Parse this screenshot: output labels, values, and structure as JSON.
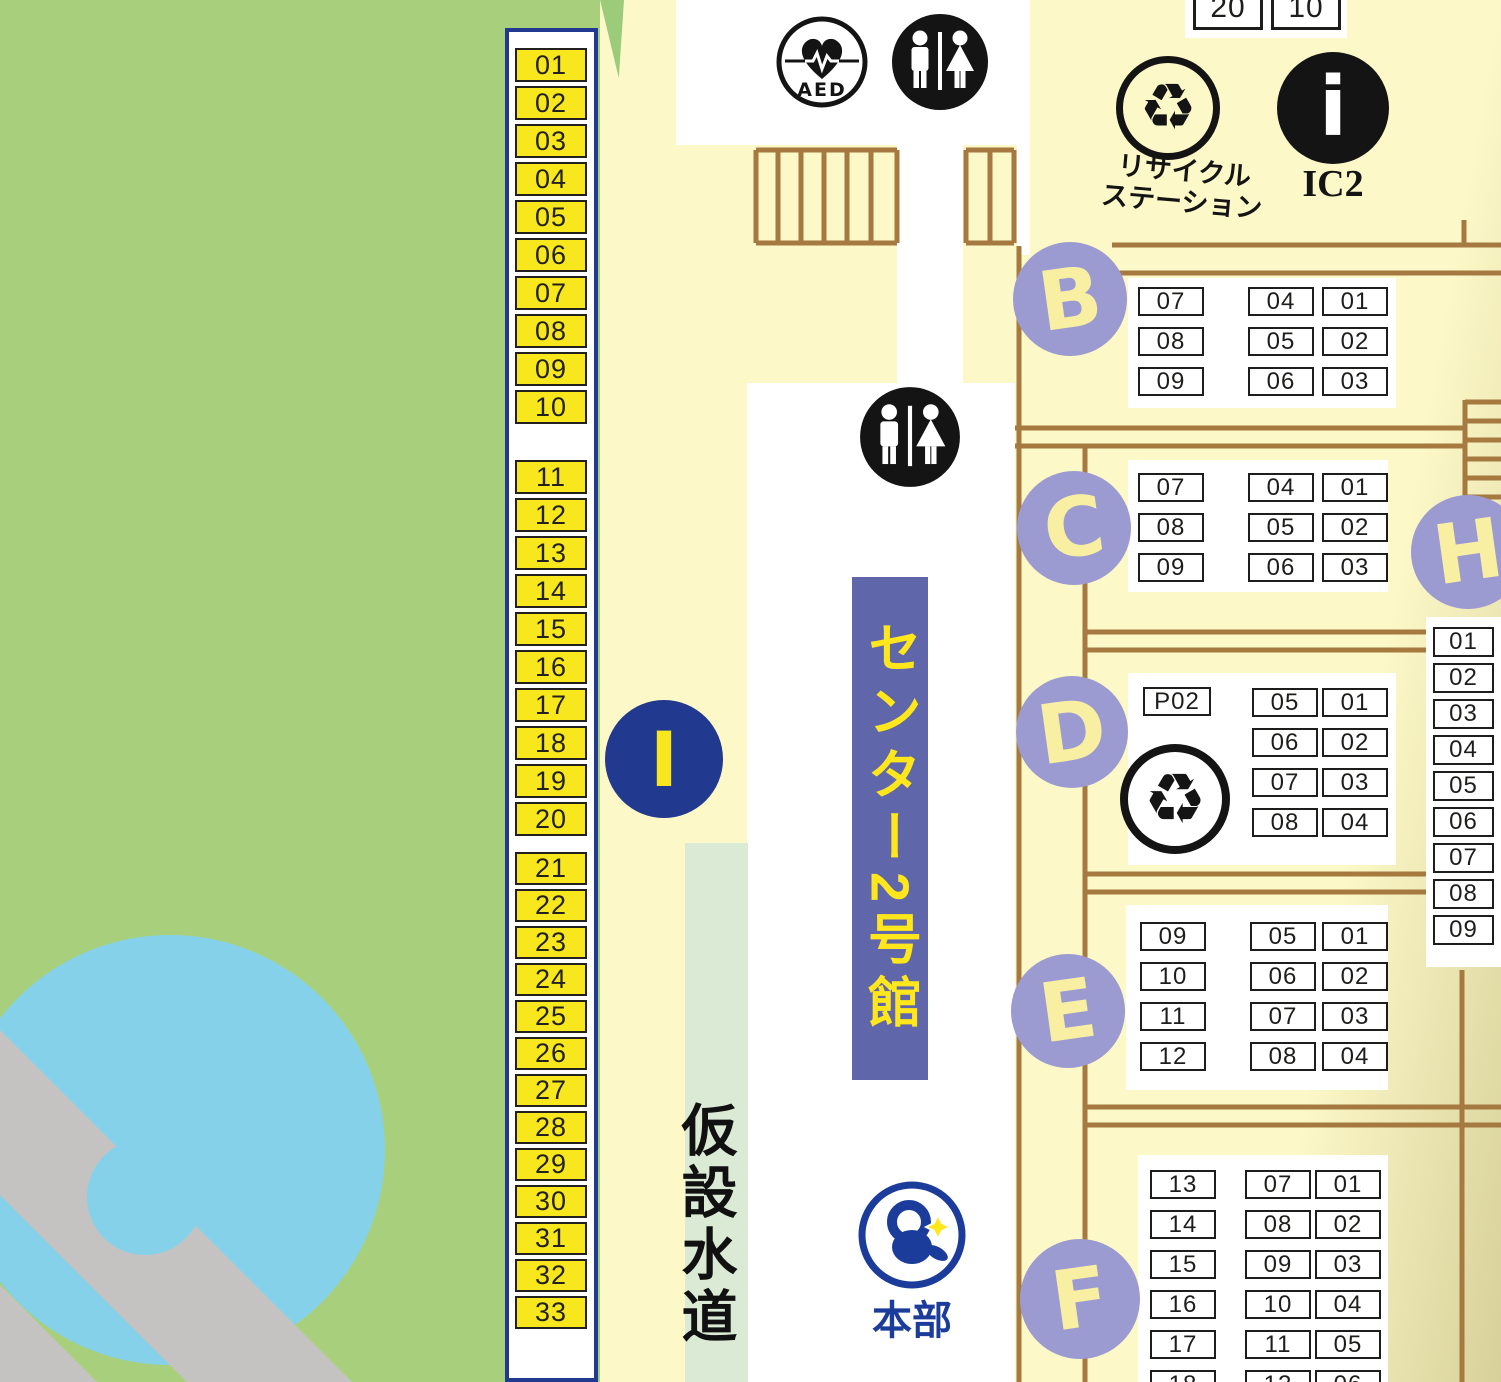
{
  "top_counter": {
    "boxes": [
      "20",
      "10"
    ]
  },
  "icons": {
    "aed_label": "AED",
    "recycle_glyph": "♻",
    "recycle_station": {
      "line1": "リサイクル",
      "line2": "ステーション"
    },
    "info": {
      "glyph": "i",
      "label": "IC2"
    }
  },
  "building_banner": "センター2号館",
  "water_supply_label": "仮設水道",
  "headquarters_label": "本部",
  "sections": {
    "I": {
      "letter": "I",
      "groups": [
        [
          "01",
          "02",
          "03",
          "04",
          "05",
          "06",
          "07",
          "08",
          "09",
          "10"
        ],
        [
          "11",
          "12",
          "13",
          "14",
          "15",
          "16",
          "17",
          "18",
          "19",
          "20"
        ],
        [
          "21",
          "22",
          "23",
          "24",
          "25",
          "26",
          "27",
          "28",
          "29",
          "30"
        ],
        [
          "31",
          "32",
          "33"
        ]
      ]
    },
    "B": {
      "letter": "B",
      "columns": [
        [
          "07",
          "08",
          "09"
        ],
        [
          "04",
          "05",
          "06"
        ],
        [
          "01",
          "02",
          "03"
        ]
      ]
    },
    "C": {
      "letter": "C",
      "columns": [
        [
          "07",
          "08",
          "09"
        ],
        [
          "04",
          "05",
          "06"
        ],
        [
          "01",
          "02",
          "03"
        ]
      ]
    },
    "D": {
      "letter": "D",
      "pbox": "P02",
      "columns": [
        [
          "05",
          "06",
          "07",
          "08"
        ],
        [
          "01",
          "02",
          "03",
          "04"
        ]
      ]
    },
    "E": {
      "letter": "E",
      "columns": [
        [
          "09",
          "10",
          "11",
          "12"
        ],
        [
          "05",
          "06",
          "07",
          "08"
        ],
        [
          "01",
          "02",
          "03",
          "04"
        ]
      ]
    },
    "F": {
      "letter": "F",
      "columns": [
        [
          "13",
          "14",
          "15",
          "16",
          "17",
          "18"
        ],
        [
          "07",
          "08",
          "09",
          "10",
          "11",
          "12"
        ],
        [
          "01",
          "02",
          "03",
          "04",
          "05",
          "06"
        ]
      ]
    },
    "H": {
      "letter": "H",
      "column": [
        "01",
        "02",
        "03",
        "04",
        "05",
        "06",
        "07",
        "08",
        "09"
      ]
    }
  },
  "colors": {
    "ground_yellow": "#fcf8c7",
    "park_green": "#a8d07c",
    "pond_blue": "#85d1ea",
    "path_gray": "#c4c3c2",
    "wall_brown": "#a5793f",
    "marker_purple": "#9c9bd1",
    "marker_letter_yellow": "#f8efa2",
    "stall_yellow": "#f8e71d",
    "strip_navy": "#21398f",
    "banner_purple": "#5f66a9",
    "banner_text_yellow": "#ffe71c",
    "water_strip_green": "#dbead5",
    "hq_navy": "#1c3c9c"
  }
}
